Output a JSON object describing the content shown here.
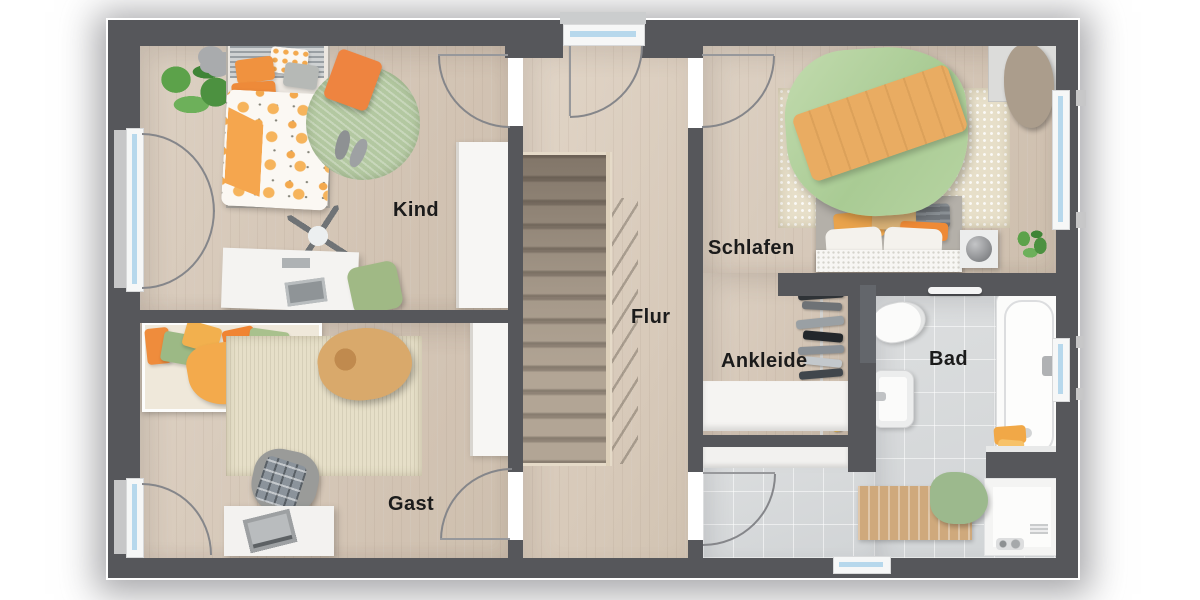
{
  "floorplan": {
    "rooms": [
      {
        "id": "kind",
        "label": "Kind"
      },
      {
        "id": "gast",
        "label": "Gast"
      },
      {
        "id": "flur",
        "label": "Flur"
      },
      {
        "id": "schlafen",
        "label": "Schlafen"
      },
      {
        "id": "ankleide",
        "label": "Ankleide"
      },
      {
        "id": "bad",
        "label": "Bad"
      }
    ],
    "palette": {
      "wall": "#56575b",
      "wood_floor": "#d8cbbc",
      "tile_floor": "#d7dadc",
      "stair_tread": "#a89b8d",
      "window_glass": "#b7d8ec",
      "rug_green": "#b3c8a1",
      "rug_beige": "#e6dfc8",
      "duvet_green": "#b5d3a0",
      "accent_orange": "#ef8c3c",
      "throw_orange": "#e9ac62"
    },
    "fixtures": [
      "stairs",
      "bathtub",
      "shower",
      "toilet",
      "sink",
      "beds",
      "wardrobes",
      "desks",
      "plants",
      "clothes-rack"
    ]
  }
}
